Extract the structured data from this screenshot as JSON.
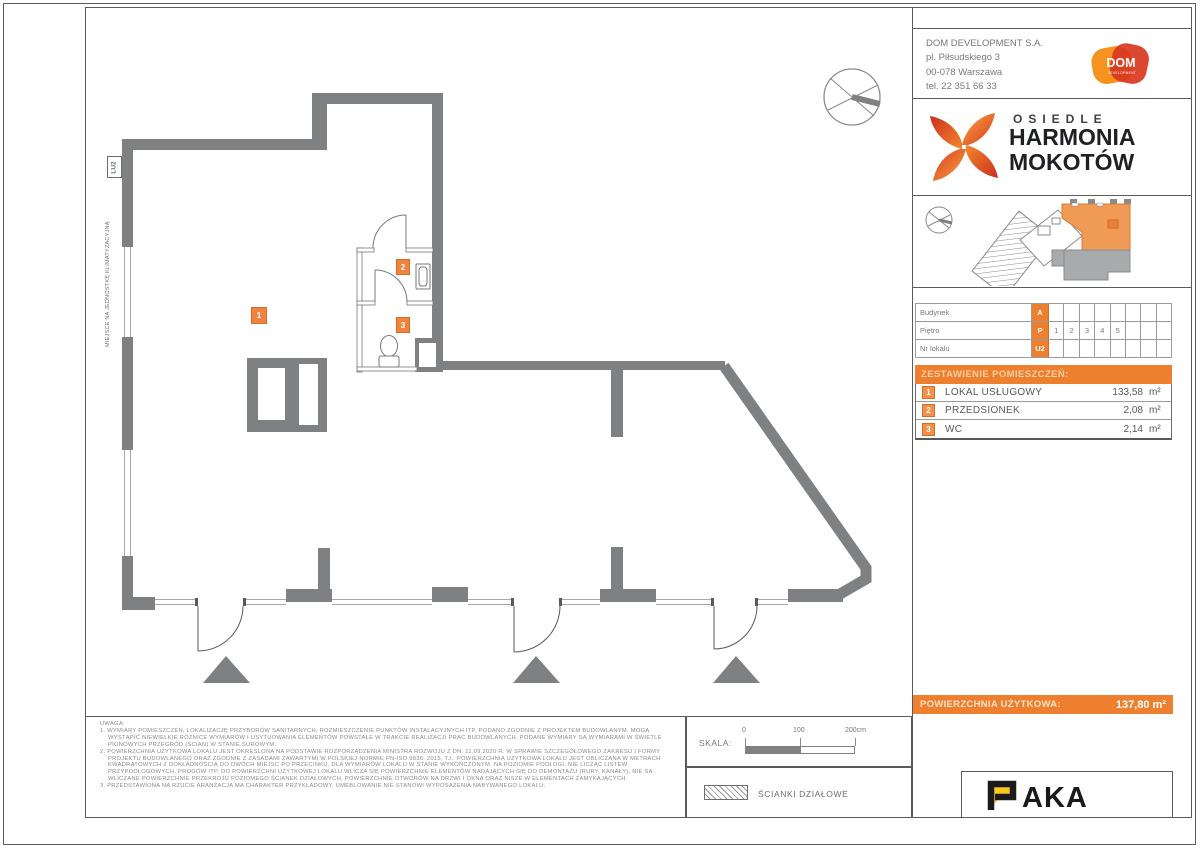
{
  "company": {
    "name": "DOM DEVELOPMENT S.A.",
    "address_line1": "pl. Piłsudskiego 3",
    "address_line2": "00-078 Warszawa",
    "phone": "tel. 22 351 66 33",
    "logo_text": "DOM",
    "logo_subtext": "DEVELOPMENT"
  },
  "project": {
    "estate_label": "OSIEDLE",
    "name_line1": "HARMONIA",
    "name_line2": "MOKOTÓW"
  },
  "unit_info": {
    "rows": [
      {
        "label": "Budynek",
        "value": "A",
        "cells": [
          "",
          "",
          "",
          "",
          "",
          "",
          "",
          ""
        ]
      },
      {
        "label": "Piętro",
        "value": "P",
        "cells": [
          "1",
          "2",
          "3",
          "4",
          "5",
          "",
          "",
          ""
        ]
      },
      {
        "label": "Nr lokalu",
        "value": "U2",
        "cells": [
          "",
          "",
          "",
          "",
          "",
          "",
          "",
          ""
        ]
      }
    ]
  },
  "rooms": {
    "header": "ZESTAWIENIE POMIESZCZEŃ:",
    "rows": [
      {
        "no": "1",
        "name": "LOKAL USŁUGOWY",
        "area": "133,58",
        "unit": "m²"
      },
      {
        "no": "2",
        "name": "PRZEDSIONEK",
        "area": "2,08",
        "unit": "m²"
      },
      {
        "no": "3",
        "name": "WC",
        "area": "2,14",
        "unit": "m²"
      }
    ],
    "total_label": "POWIERZCHNIA UŻYTKOWA:",
    "total_area": "137,80",
    "total_unit": "m²"
  },
  "plan": {
    "ac_note": "MIEJSCE NA JEDNOSTKĘ KLIMATYZACYJNĄ",
    "unit_label": "LU2",
    "markers": [
      "1",
      "2",
      "3"
    ]
  },
  "scale": {
    "label": "SKALA:",
    "ticks": [
      "0",
      "100",
      "200cm"
    ]
  },
  "legend": {
    "partition_label": "ŚCIANKI DZIAŁOWE"
  },
  "notes": {
    "title": "UWAGA:",
    "items": [
      "1. WYMIARY POMIESZCZEŃ, LOKALIZACJĘ PRZYBORÓW SANITARNYCH, ROZMIESZCZENIE PUNKTÓW INSTALACYJNYCH ITP. PODANO ZGODNIE Z PROJEKTEM BUDOWLANYM. MOGĄ WYSTĄPIĆ NIEWIELKIE RÓŻNICE WYMIARÓW I USYTUOWANIA ELEMENTÓW POWSTAŁE W TRAKCIE REALIZACJI PRAC BUDOWLANYCH. PODANE WYMIARY SĄ WYMIARAMI W ŚWIETLE PIONOWYCH PRZEGRÓD (ŚCIAN) W STANIE SUROWYM.",
      "2. POWIERZCHNIA UŻYTKOWA LOKALU JEST OKREŚLONA NA PODSTAWIE ROZPORZĄDZENIA MINISTRA ROZWOJU Z DN. 11.09.2020 R. W SPRAWIE SZCZEGÓŁOWEGO ZAKRESU I FORMY PROJEKTU BUDOWLANEGO ORAZ ZGODNIE Z ZASADAMI ZAWARTYMI W POLSKIEJ NORMIE PN-ISO 9836: 2015, TJ.: POWIERZCHNIA UŻYTKOWA LOKALU JEST OBLICZANA W METRACH KWADRATOWYCH Z DOKŁADNOŚCIĄ DO DWÓCH MIEJSC PO PRZECINKU, DLA WYMIARÓW LOKALU W STANIE WYKOŃCZONYM, NA POZIOMIE PODŁOGI, NIE LICZĄC LISTEW PRZYPODŁOGOWYCH, PROGÓW ITP. DO POWIERZCHNI UŻYTKOWEJ LOKALU WLICZA SIĘ POWIERZCHNIE ELEMENTÓW NADAJĄCYCH SIĘ DO DEMONTAŻU (RURY, KANAŁY), NIE SĄ WLICZANE POWIERZCHNIE PRZEKROJU POZIOMEGO ŚCIANEK DZIAŁOWYCH, POWIERZCHNIE OTWORÓW NA DRZWI I OKNA ORAZ NISZE W ELEMENTACH ZAMYKAJĄCYCH.",
      "3. PRZEDSTAWIONA NA RZUCIE ARANŻACJA MA CHARAKTER PRZYKŁADOWY, UMEBLOWANIE NIE STANOWI WYPOSAŻENIA NABYWANEGO LOKALU."
    ]
  },
  "footer_logo": {
    "text_rest": "AKA"
  },
  "colors": {
    "accent_orange": "#EE7F2E",
    "badge_orange": "#F0914C",
    "badge_border": "#D96C20",
    "wall_gray": "#7F8082",
    "paka_yellow": "#F8C81C",
    "logo_orange": "#F6921E",
    "logo_red": "#D8391F"
  }
}
